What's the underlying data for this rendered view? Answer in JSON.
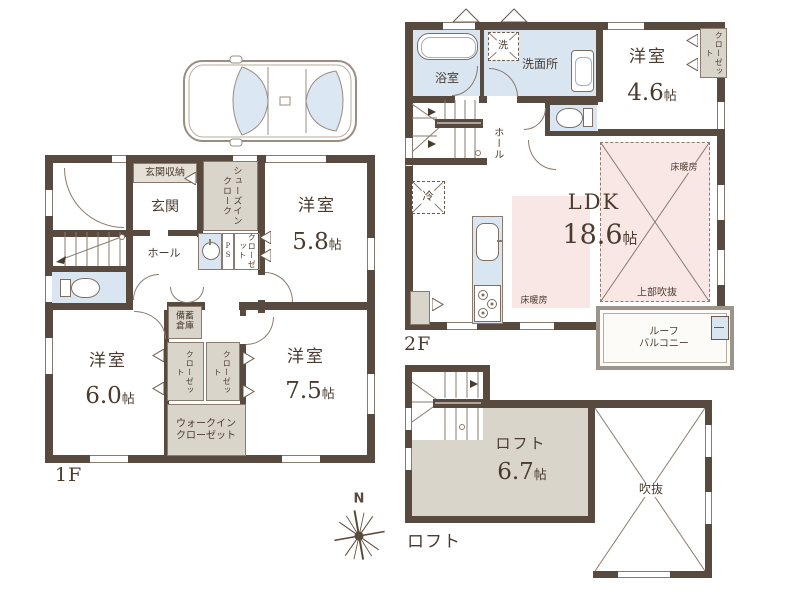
{
  "floor1": {
    "floor_label": "1F",
    "entrance_storage": "玄関収納",
    "entrance": "玄関",
    "shoes_in_closet": "シューズインクローク",
    "hall": "ホール",
    "pipe_space": "PS",
    "closet_hall": "クローゼット",
    "stock_storage_line1": "備蓄",
    "stock_storage_line2": "倉庫",
    "room_58": {
      "name": "洋室",
      "size_num": "5.8",
      "size_unit": "帖"
    },
    "room_60": {
      "name": "洋室",
      "size_num": "6.0",
      "size_unit": "帖"
    },
    "room_75": {
      "name": "洋室",
      "size_num": "7.5",
      "size_unit": "帖"
    },
    "closet_left": "クローゼット",
    "closet_right": "クローゼット",
    "walk_in_closet_line1": "ウォークイン",
    "walk_in_closet_line2": "クローゼット"
  },
  "floor2": {
    "floor_label": "2F",
    "bathroom": "浴室",
    "laundry": "洗",
    "washroom": "洗面所",
    "hall": "ホール",
    "refrigerator": "冷",
    "room_46": {
      "name": "洋室",
      "size_num": "4.6",
      "size_unit": "帖"
    },
    "closet": "クローゼット",
    "ldk": {
      "name": "LDK",
      "size_num": "18.6",
      "size_unit": "帖"
    },
    "floor_heating_left": "床暖房",
    "floor_heating_right": "床暖房",
    "void_above": "上部吹抜",
    "roof_balcony_line1": "ルーフ",
    "roof_balcony_line2": "バルコニー"
  },
  "loft": {
    "floor_label": "ロフト",
    "room": {
      "name": "ロフト",
      "size_num": "6.7",
      "size_unit": "帖"
    },
    "void": "吹抜"
  },
  "compass": {
    "north": "N"
  }
}
